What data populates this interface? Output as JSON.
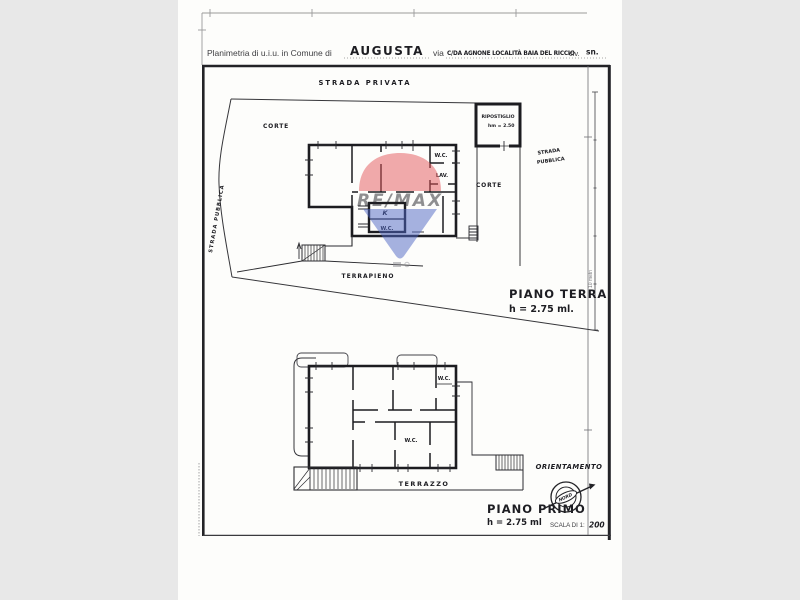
{
  "header": {
    "prefix": "Planimetria di u.i.u. in Comune di",
    "comune": "AUGUSTA",
    "via_label": "via",
    "via_value": "C/DA AGNONE LOCALITÀ BAIA DEL RICCIO",
    "civ_label": "civ.",
    "civ_value": "sn."
  },
  "site_plan": {
    "strada_privata": "STRADA PRIVATA",
    "strada_pubblica": "STRADA PUBBLICA",
    "strada_word": "STRADA",
    "pubblica_word": "PUBBLICA",
    "corte": "CORTE",
    "ripostiglio_name": "RIPOSTIGLIO",
    "ripostiglio_height": "hm = 2.50",
    "terrapieno": "TERRAPIENO"
  },
  "ground_floor": {
    "title": "PIANO TERRA",
    "height": "h = 2.75 ml.",
    "wc_top": "W.C.",
    "lav": "LAV.",
    "kitchen": "K",
    "wc_bottom": "W.C."
  },
  "first_floor": {
    "title": "PIANO PRIMO",
    "height": "h = 2.75 ml",
    "wc_top": "W.C.",
    "wc_bottom": "W.C.",
    "terrazzo": "TERRAZZO"
  },
  "legend": {
    "scale_bar": "10 metri",
    "orientamento": "ORIENTAMENTO",
    "nord": "NORD",
    "scala_label": "SCALA DI 1:",
    "scala_value": "200"
  },
  "watermark": {
    "brand": "RE/MAX",
    "red": "#e4575b",
    "blue": "#4f67c5"
  },
  "colors": {
    "background": "#e8e8e8",
    "paper": "#fdfdfb",
    "ink": "#1c1c20"
  }
}
